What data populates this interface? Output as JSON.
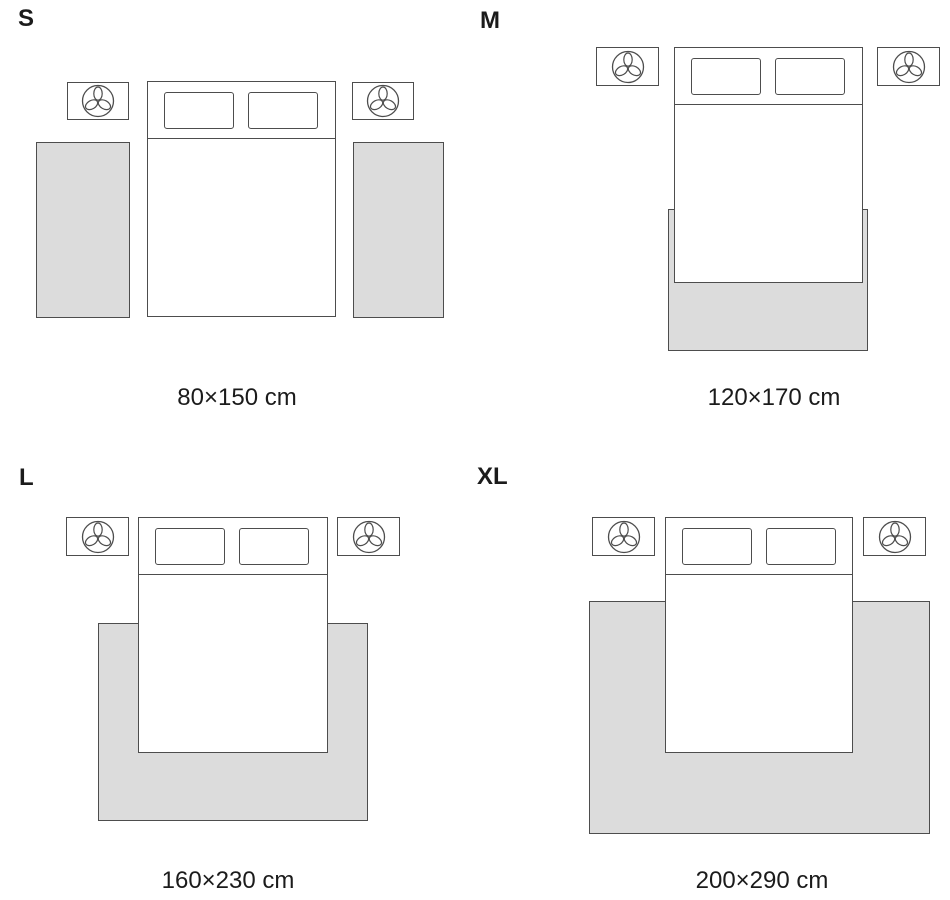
{
  "colors": {
    "rug_fill": "#dcdcdc",
    "outline": "#4d4d4d",
    "text": "#1b1b1b",
    "bed_fill": "#ffffff"
  },
  "icons": {
    "nightstand_icon": "plant-icon"
  },
  "panels": [
    {
      "label": "S",
      "caption": "80×150 cm",
      "rug_placement": "two side runners beside bed"
    },
    {
      "label": "M",
      "caption": "120×170 cm",
      "rug_placement": "under lower end of bed"
    },
    {
      "label": "L",
      "caption": "160×230 cm",
      "rug_placement": "under lower two-thirds of bed, extending past sides"
    },
    {
      "label": "XL",
      "caption": "200×290 cm",
      "rug_placement": "large area under bed, extending far past sides and foot"
    }
  ]
}
